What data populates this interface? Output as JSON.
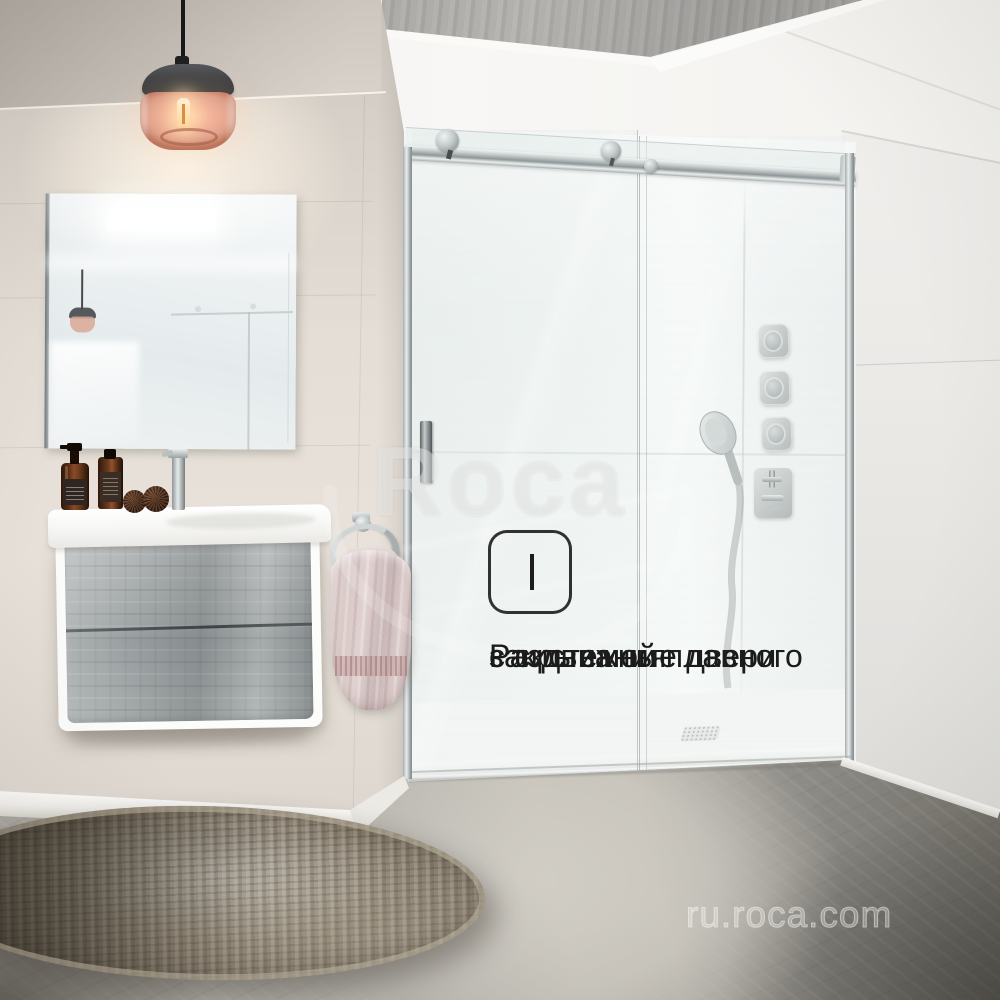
{
  "overlay": {
    "caption_lines": [
      "Раздвижные двери",
      "с системой плавного",
      "закрывания"
    ],
    "brand_watermark": "Roca",
    "url_watermark": "ru.roca.com"
  },
  "feature_icon": {
    "name": "soft-close-barcode-icon",
    "bar_widths": [
      2,
      4,
      4,
      4,
      4,
      4,
      4,
      4,
      4,
      2
    ]
  },
  "palette": {
    "caption_text": "#1b1b1b",
    "left_wall": "#e4ded6",
    "concrete": "#a8a7a4",
    "right_wall": "#eceae7",
    "shower_wall": "#f5f8f7",
    "chrome_light": "#e9eded",
    "chrome_dark": "#8a9192",
    "floor_light": "#c7c4bd",
    "floor_dark": "#6f6d66",
    "rug_base": "#8a8071",
    "rug_rim": "#c4baa6",
    "towel": "#d8c8c6",
    "lamp_shade": "#e0a28c",
    "lamp_cap": "#3a3e42",
    "drawer_concrete": "#a8adae",
    "bottle_amber": "#6b3a1e",
    "watermark_white": "rgba(255,255,255,0.36)"
  }
}
